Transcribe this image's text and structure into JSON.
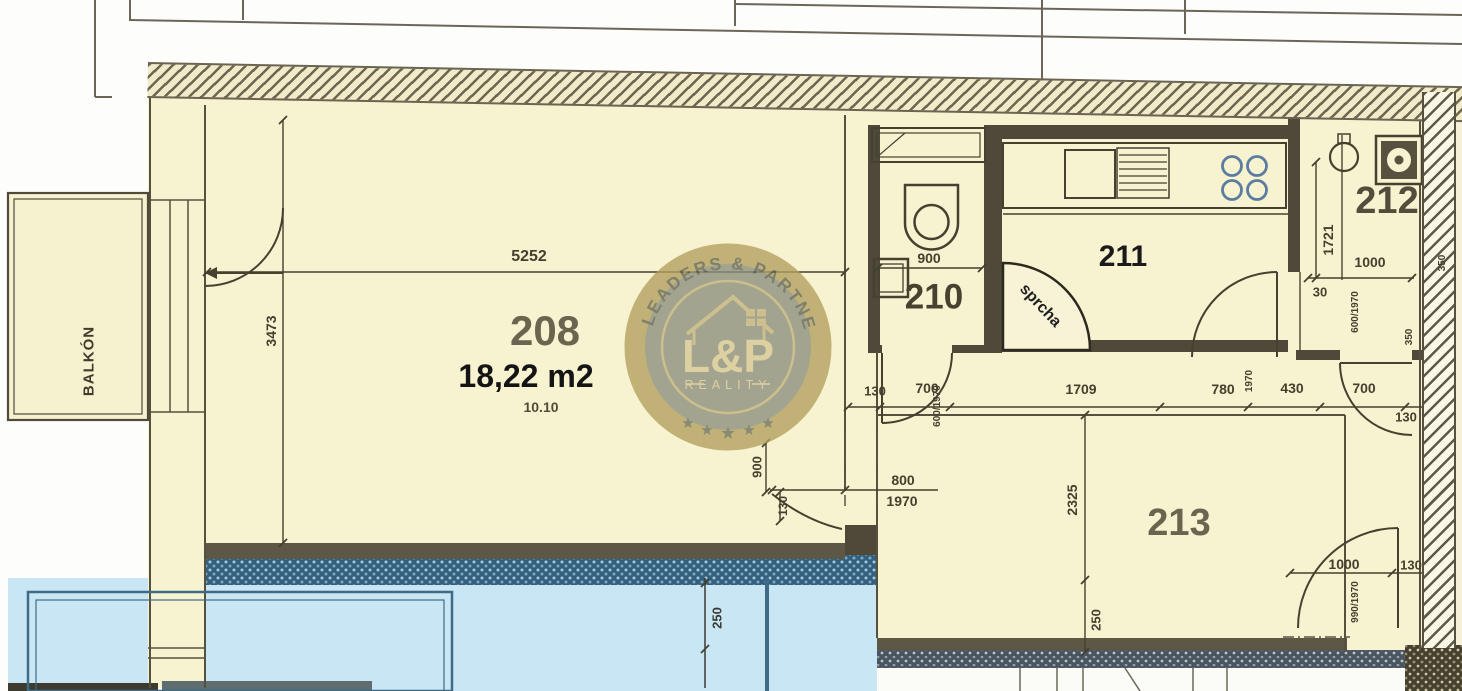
{
  "watermark": {
    "arc_text": "LEADERS & PARTNERS",
    "monogram": "L&P",
    "subtitle": "REALITY"
  },
  "colors": {
    "paper": "#f7f2d0",
    "wall": "#4e4939",
    "blue_area": "#c9e6f5",
    "blue_wall": "#33607f",
    "cooktop": "#5b7da0",
    "watermark_gold": "#b2a05e",
    "watermark_disc": "#8c8f7e"
  },
  "labels": [
    {
      "name": "balkon-label",
      "text": "BALKÓN",
      "x": 89,
      "y": 361,
      "rot": -90,
      "size": 15,
      "weight": 700,
      "color": "#3f3b2d",
      "ls": 1
    },
    {
      "name": "room-208-number",
      "text": "208",
      "x": 545,
      "y": 331,
      "size": 42,
      "weight": 700,
      "color": "#6a654f"
    },
    {
      "name": "room-208-area",
      "text": "18,22 m2",
      "x": 526,
      "y": 376,
      "size": 32,
      "weight": 700,
      "color": "#141414"
    },
    {
      "name": "room-208-note",
      "text": "10.10",
      "x": 541,
      "y": 407,
      "size": 14,
      "weight": 700,
      "color": "#504b38"
    },
    {
      "name": "room-210-number",
      "text": "210",
      "x": 934,
      "y": 297,
      "size": 35,
      "weight": 700,
      "color": "#474130"
    },
    {
      "name": "room-211-number",
      "text": "211",
      "x": 1123,
      "y": 257,
      "size": 30,
      "weight": 700,
      "color": "#1a1a1a"
    },
    {
      "name": "room-212-number",
      "text": "212",
      "x": 1387,
      "y": 201,
      "size": 38,
      "weight": 700,
      "color": "#534e3b"
    },
    {
      "name": "room-213-number",
      "text": "213",
      "x": 1179,
      "y": 523,
      "size": 38,
      "weight": 700,
      "color": "#6a654f"
    },
    {
      "name": "sprcha-label",
      "text": "sprcha",
      "x": 1040,
      "y": 306,
      "rot": 47,
      "size": 16,
      "weight": 600,
      "color": "#1f1f1f"
    },
    {
      "name": "dim-5252",
      "text": "5252",
      "x": 529,
      "y": 257,
      "size": 16,
      "weight": 700,
      "color": "#45402e"
    },
    {
      "name": "dim-3473",
      "text": "3473",
      "x": 271,
      "y": 331,
      "rot": -90,
      "size": 14,
      "weight": 700,
      "color": "#45402e"
    },
    {
      "name": "dim-900-wc",
      "text": "900",
      "x": 929,
      "y": 258,
      "size": 14,
      "weight": 700,
      "color": "#45402e"
    },
    {
      "name": "dim-130-a",
      "text": "130",
      "x": 875,
      "y": 391,
      "size": 13,
      "weight": 700,
      "color": "#45402e"
    },
    {
      "name": "dim-700-a",
      "text": "700",
      "x": 927,
      "y": 388,
      "size": 14,
      "weight": 700,
      "color": "#45402e"
    },
    {
      "name": "dim-door-600-1970-a",
      "text": "600/1970",
      "x": 938,
      "y": 406,
      "rot": -90,
      "size": 10,
      "weight": 700,
      "color": "#45402e"
    },
    {
      "name": "dim-1709",
      "text": "1709",
      "x": 1081,
      "y": 389,
      "size": 14,
      "weight": 700,
      "color": "#45402e"
    },
    {
      "name": "dim-780",
      "text": "780",
      "x": 1223,
      "y": 389,
      "size": 14,
      "weight": 700,
      "color": "#45402e"
    },
    {
      "name": "dim-door-1970",
      "text": "1970",
      "x": 1250,
      "y": 381,
      "rot": -90,
      "size": 10,
      "weight": 700,
      "color": "#45402e"
    },
    {
      "name": "dim-430",
      "text": "430",
      "x": 1292,
      "y": 388,
      "size": 14,
      "weight": 700,
      "color": "#45402e"
    },
    {
      "name": "dim-700-b",
      "text": "700",
      "x": 1364,
      "y": 388,
      "size": 14,
      "weight": 700,
      "color": "#45402e"
    },
    {
      "name": "dim-130-b",
      "text": "130",
      "x": 1406,
      "y": 417,
      "size": 13,
      "weight": 700,
      "color": "#45402e"
    },
    {
      "name": "dim-1721",
      "text": "1721",
      "x": 1328,
      "y": 240,
      "rot": -90,
      "size": 14,
      "weight": 700,
      "color": "#45402e"
    },
    {
      "name": "dim-1000-212",
      "text": "1000",
      "x": 1370,
      "y": 262,
      "size": 14,
      "weight": 700,
      "color": "#45402e"
    },
    {
      "name": "dim-30",
      "text": "30",
      "x": 1320,
      "y": 292,
      "size": 13,
      "weight": 700,
      "color": "#45402e"
    },
    {
      "name": "dim-door-600-1970-b",
      "text": "600/1970",
      "x": 1356,
      "y": 312,
      "rot": -90,
      "size": 10,
      "weight": 700,
      "color": "#45402e"
    },
    {
      "name": "dim-900-v",
      "text": "900",
      "x": 757,
      "y": 467,
      "rot": -90,
      "size": 13,
      "weight": 700,
      "color": "#45402e"
    },
    {
      "name": "dim-130-v",
      "text": "130",
      "x": 783,
      "y": 506,
      "rot": -90,
      "size": 12,
      "weight": 700,
      "color": "#45402e"
    },
    {
      "name": "dim-door-800",
      "text": "800",
      "x": 903,
      "y": 480,
      "size": 14,
      "weight": 700,
      "color": "#45402e"
    },
    {
      "name": "dim-door-800-h",
      "text": "1970",
      "x": 902,
      "y": 501,
      "size": 14,
      "weight": 700,
      "color": "#45402e"
    },
    {
      "name": "dim-2325",
      "text": "2325",
      "x": 1072,
      "y": 500,
      "rot": -90,
      "size": 14,
      "weight": 700,
      "color": "#45402e"
    },
    {
      "name": "dim-250-left",
      "text": "250",
      "x": 717,
      "y": 618,
      "rot": -90,
      "size": 13,
      "weight": 700,
      "color": "#3a3a34"
    },
    {
      "name": "dim-250-right",
      "text": "250",
      "x": 1096,
      "y": 620,
      "rot": -90,
      "size": 13,
      "weight": 700,
      "color": "#45402e"
    },
    {
      "name": "dim-1000-door",
      "text": "1000",
      "x": 1344,
      "y": 564,
      "size": 14,
      "weight": 700,
      "color": "#45402e"
    },
    {
      "name": "dim-130-c",
      "text": "130",
      "x": 1411,
      "y": 565,
      "size": 13,
      "weight": 700,
      "color": "#45402e"
    },
    {
      "name": "dim-door-990-1970",
      "text": "990/1970",
      "x": 1356,
      "y": 602,
      "rot": -90,
      "size": 10,
      "weight": 700,
      "color": "#45402e"
    },
    {
      "name": "dim-350-a",
      "text": "350",
      "x": 1443,
      "y": 263,
      "rot": -90,
      "size": 10,
      "weight": 700,
      "color": "#45402e"
    },
    {
      "name": "dim-350-b",
      "text": "350",
      "x": 1410,
      "y": 337,
      "rot": -90,
      "size": 10,
      "weight": 700,
      "color": "#45402e"
    }
  ]
}
